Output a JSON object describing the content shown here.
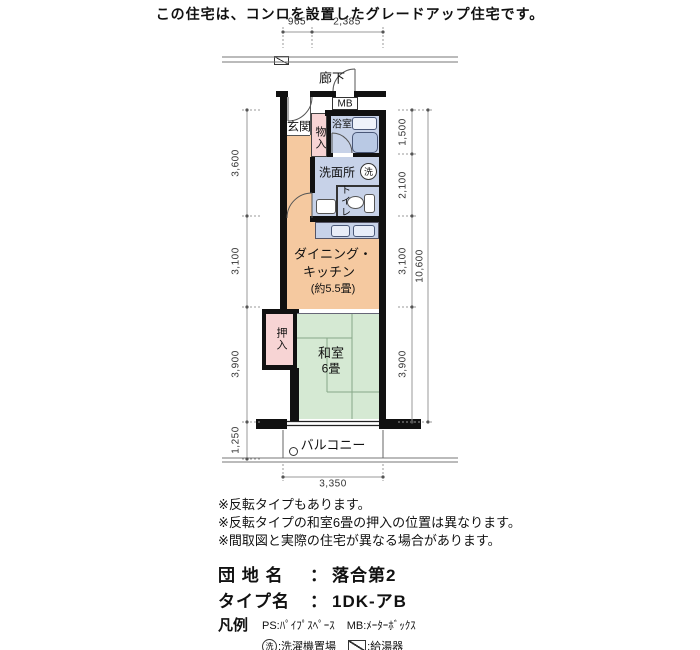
{
  "title": "この住宅は、コンロを設置したグレードアップ住宅です。",
  "plan": {
    "corridor_label": "廊下",
    "mb_label": "MB",
    "genkan_label": "玄関",
    "monoire_label": "物入",
    "bath_label": "浴室",
    "senmenjo_label": "洗面所",
    "washer_symbol": "洗",
    "toilet_label": "トイレ",
    "dk_line1": "ダイニング・",
    "dk_line2": "キッチン",
    "dk_line3": "(約5.5畳)",
    "oshiire_label": "押入",
    "washitsu_label": "和室",
    "washitsu_size": "6畳",
    "balcony_label": "バルコニー"
  },
  "dimensions": {
    "top": [
      "965",
      "2,385"
    ],
    "left": [
      "3,600",
      "3,100",
      "3,900",
      "1,250"
    ],
    "right": [
      "1,500",
      "2,100",
      "3,100",
      "3,900"
    ],
    "right_total": "10,600",
    "bottom": "3,350"
  },
  "notes": [
    "※反転タイプもあります。",
    "※反転タイプの和室6畳の押入の位置は異なります。",
    "※間取図と実際の住宅が異なる場合があります。"
  ],
  "info": {
    "estate_label": "団 地 名",
    "separator": "：",
    "estate_value": "落合第2",
    "type_label": "タイプ名",
    "type_value": "1DK-アB"
  },
  "legend": {
    "title": "凡例",
    "ps": "PS:ﾊﾟｲﾌﾟｽﾍﾟｰｽ",
    "mb": "MB:ﾒｰﾀｰﾎﾞｯｸｽ",
    "washer_symbol": "洗",
    "washer_text": ":洗濯機置場",
    "heater_text": ":給湯器"
  },
  "colors": {
    "dk": "#f5c9a0",
    "tatami": "#d5e9d3",
    "closet": "#f7d4d4",
    "wet": "#c7d2e8",
    "tub": "#b9c9e4"
  }
}
